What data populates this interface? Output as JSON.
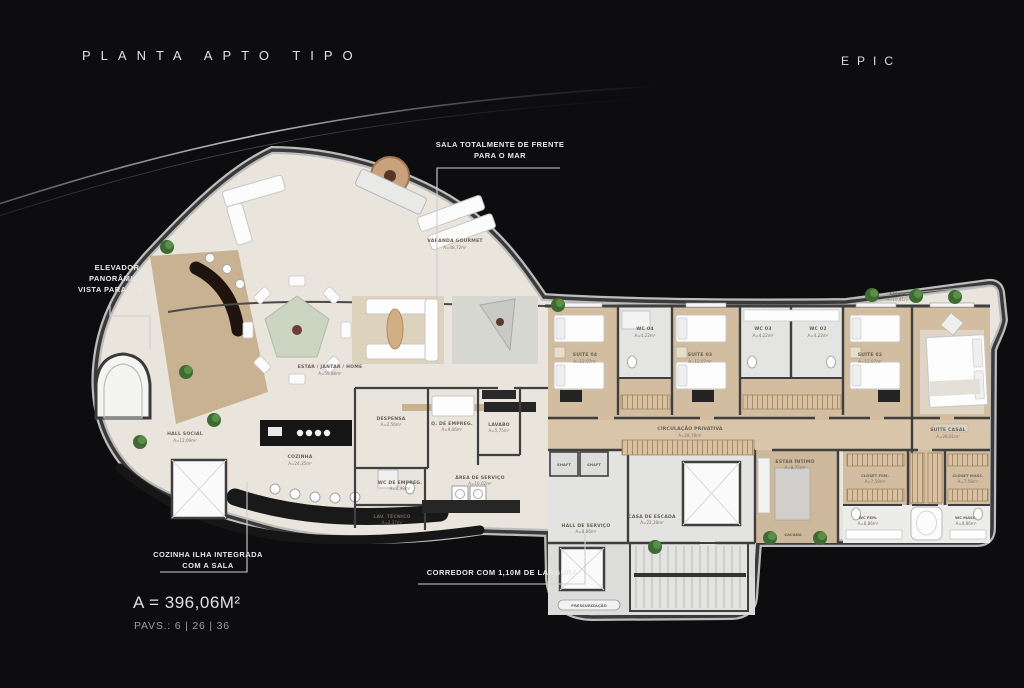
{
  "header": {
    "title": "PLANTA APTO TIPO",
    "brand": "EPIC"
  },
  "callouts": {
    "elevator": [
      "ELEVADOR",
      "PANORÂMICO",
      "VISTA PARA O MAR"
    ],
    "sala": [
      "SALA TOTALMENTE DE FRENTE",
      "PARA O MAR"
    ],
    "cozinha": [
      "COZINHA ILHA INTEGRADA",
      "COM A SALA"
    ],
    "corredor": [
      "CORREDOR COM 1,10M DE LARGURA"
    ]
  },
  "stats": {
    "area": "A = 396,06M²",
    "pavements": "PAVS.: 6 | 26 | 36"
  },
  "colors": {
    "background": "#0d0d0f",
    "floor": "#e9e5dd",
    "wood": "#cdb697",
    "wall": "#3f3f3f",
    "plant": "#4d7a3a",
    "counter": "#191919"
  },
  "plan": {
    "rooms": [
      {
        "label": "VARANDA GOURMET",
        "area": "A=48,72m²"
      },
      {
        "label": "ESTAR / JANTAR / HOME",
        "area": "A=59,86m²"
      },
      {
        "label": "HALL SOCIAL",
        "area": "A=12,09m²"
      },
      {
        "label": "COZINHA",
        "area": "A=24,35m²"
      },
      {
        "label": "DESPENSA",
        "area": "A=2,56m²"
      },
      {
        "label": "Q. DE EMPREG.",
        "area": "A=9,06m²"
      },
      {
        "label": "LAVABO",
        "area": "A=5,75m²"
      },
      {
        "label": "WC DE EMPREG.",
        "area": "A=2,98m²"
      },
      {
        "label": "LAV. TÉCNICO",
        "area": "A=2,37m²"
      },
      {
        "label": "ÁREA DE SERVIÇO",
        "area": "A=10,02m²"
      },
      {
        "label": "SUÍTE 04",
        "area": "A=12,07m²"
      },
      {
        "label": "WC 04",
        "area": "A=4,22m²"
      },
      {
        "label": "SUÍTE 03",
        "area": "A=12,07m²"
      },
      {
        "label": "WC 03",
        "area": "A=4,22m²"
      },
      {
        "label": "WC 02",
        "area": "A=4,22m²"
      },
      {
        "label": "SUÍTE 02",
        "area": "A=12,07m²"
      },
      {
        "label": "SUÍTE CASAL",
        "area": "A=28,81m²"
      },
      {
        "label": "SACADA",
        "area": "A=10,81m²"
      },
      {
        "label": "CIRCULAÇÃO PRIVATIVA",
        "area": "A=28,78m²"
      },
      {
        "label": "SHAFT",
        "area": ""
      },
      {
        "label": "SHAFT",
        "area": ""
      },
      {
        "label": "HALL DE SERVIÇO",
        "area": "A=8,06m²"
      },
      {
        "label": "CASA DE ESCADA",
        "area": "A=22,28m²"
      },
      {
        "label": "ESTAR ÍNTIMO",
        "area": "A=8,75m²"
      },
      {
        "label": "SACADA",
        "area": "A=3,80m²"
      },
      {
        "label": "CLOSET FEM.",
        "area": "A=7,58m²"
      },
      {
        "label": "CLOSET MASC.",
        "area": "A=7,58m²"
      },
      {
        "label": "WC FEM.",
        "area": "A=8,86m²"
      },
      {
        "label": "WC MASC.",
        "area": "A=8,86m²"
      },
      {
        "label": "PRESSURIZAÇÃO",
        "area": ""
      }
    ]
  }
}
